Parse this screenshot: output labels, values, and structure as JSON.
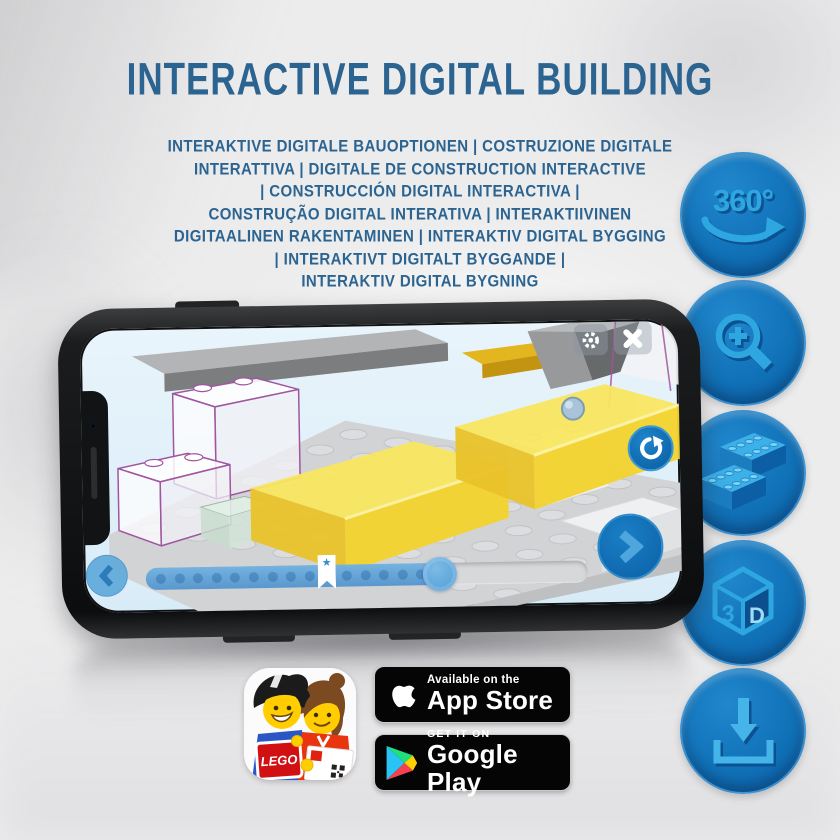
{
  "header": {
    "title": "INTERACTIVE DIGITAL BUILDING",
    "subtitle_lines": [
      "INTERAKTIVE DIGITALE BAUOPTIONEN | COSTRUZIONE DIGITALE",
      "INTERATTIVA | DIGITALE DE CONSTRUCTION INTERACTIVE",
      "| CONSTRUCCIÓN DIGITAL INTERACTIVA |",
      "CONSTRUÇÃO DIGITAL INTERATIVA | INTERAKTIIVINEN",
      "DIGITAALINEN RAKENTAMINEN | INTERAKTIV DIGITAL BYGGING",
      "| INTERAKTIVT DIGITALT BYGGANDE |",
      "INTERAKTIV DIGITAL BYGNING"
    ]
  },
  "feature_buttons": [
    {
      "id": "rotate-360",
      "label": "360°"
    },
    {
      "id": "zoom-in",
      "label": ""
    },
    {
      "id": "brick-options",
      "label": ""
    },
    {
      "id": "view-3d",
      "label_left": "3",
      "label_right": "D"
    },
    {
      "id": "download",
      "label": ""
    }
  ],
  "phone": {
    "screen": {
      "settings_button": "settings",
      "close_button": "close",
      "rotate_button": "rotate-model",
      "back_button": "previous-step",
      "next_button": "next-step",
      "progress": {
        "percent_complete": 64,
        "steps_shown": 15,
        "bookmark_percent": 40,
        "star_glyph": "★"
      }
    }
  },
  "badges": {
    "app_store": {
      "tagline": "Available on the",
      "store": "App Store"
    },
    "google_play": {
      "tagline": "GET IT ON",
      "store": "Google Play"
    }
  },
  "app_icon": {
    "lego_logo_text": "LEGO"
  },
  "colors": {
    "headline_blue": "#2c6491",
    "button_blue": "#1172b8",
    "icon_light_blue": "#2ea7e1",
    "icon_shadow_blue": "#0c5293",
    "screen_sky": "#ddeefa",
    "brick_yellow": "#f4d62e",
    "outline_purple": "#a055a0"
  }
}
